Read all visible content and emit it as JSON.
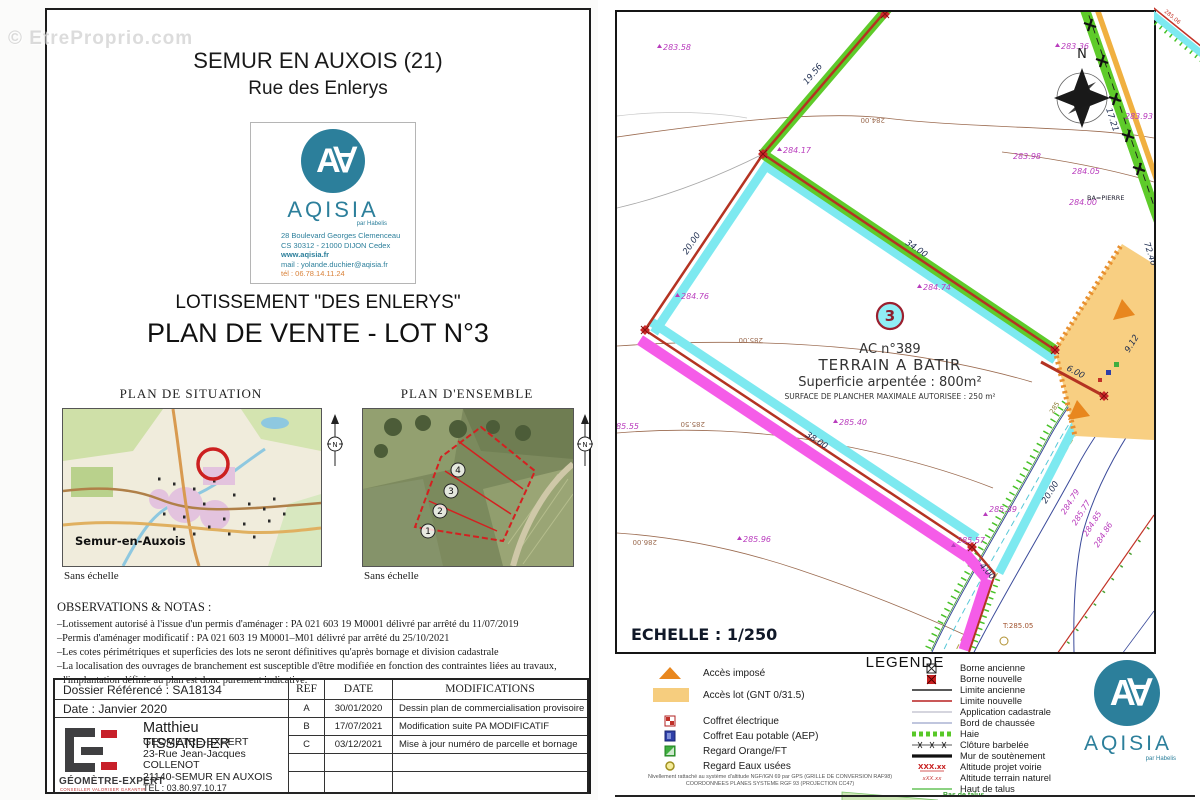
{
  "watermark": "© EtreProprio.com",
  "left_page": {
    "title_line1": "SEMUR EN AUXOIS (21)",
    "title_line2": "Rue des Enlerys",
    "logo": {
      "monogram": "A∀",
      "name": "AQISIA",
      "sub": "par Habelis",
      "address1": "28 Boulevard Georges Clemenceau",
      "address2": "CS 30312 - 21000 DIJON Cedex",
      "web": "www.aqisia.fr",
      "mail": "mail : yolande.duchier@aqisia.fr",
      "tel": "tél : 06.78.14.11.24"
    },
    "subtitle1": "LOTISSEMENT \"DES ENLERYS\"",
    "subtitle2": "PLAN DE VENTE - LOT N°3",
    "map_left_title": "PLAN DE SITUATION",
    "map_right_title": "PLAN D'ENSEMBLE",
    "map_left_caption": "Sans échelle",
    "map_right_caption": "Sans échelle",
    "map_city_label": "Semur-en-Auxois",
    "ensemble_numbers": [
      "1",
      "2",
      "3",
      "4"
    ],
    "observations_title": "OBSERVATIONS & NOTAS :",
    "obs1": "–Lotissement autorisé à l'issue d'un permis d'aménager : PA 021 603 19 M0001 délivré par arrêté du 11/07/2019",
    "obs2": "–Permis d'aménager modificatif : PA 021 603 19 M0001–M01 délivré par arrêté du 25/10/2021",
    "obs3": "–Les cotes périmétriques et superficies des lots ne seront définitives qu'après bornage et division cadastrale",
    "obs4": "–La localisation des ouvrages de branchement est susceptible d'être modifiée en fonction des contraintes liées au travaux,",
    "obs5": "l'implantation définie au plan est donc purement indicative.",
    "table": {
      "dossier": "Dossier Référencé : SA18134",
      "date": "Date : Janvier 2020",
      "headers": [
        "REF",
        "DATE",
        "MODIFICATIONS"
      ],
      "rows": [
        [
          "A",
          "30/01/2020",
          "Dessin plan de commercialisation provisoire"
        ],
        [
          "B",
          "17/07/2021",
          "Modification suite PA MODIFICATIF"
        ],
        [
          "C",
          "03/12/2021",
          "Mise à jour numéro de parcelle et bornage"
        ]
      ],
      "surveyor": {
        "name": "Matthieu TISSANDIER",
        "title": "GEOMETRE-EXPERT",
        "addr1": "23-Rue Jean-Jacques COLLENOT",
        "addr2": "21140-SEMUR EN AUXOIS",
        "tel": "TEL : 03.80.97.10.17",
        "fax": "FAX : 09.70.61.12.20",
        "mail": "matthieu.tissandier@geometre-expert.fr",
        "logo_label": "GÉOMÈTRE-EXPERT",
        "logo_sub": "CONSEILLER VALORISER GARANTIR"
      }
    }
  },
  "plan": {
    "scale": "ECHELLE : 1/250",
    "north": "N",
    "lot": "3",
    "parcel1": "AC n°389",
    "parcel2": "TERRAIN A BATIR",
    "parcel3": "Superficie arpentée : 800m²",
    "parcel4": "SURFACE DE PLANCHER MAXIMALE AUTORISEE : 250 m²",
    "dims": {
      "d1956": "19.56",
      "d2000a": "20.00",
      "d3400": "34.00",
      "d3800": "38.00",
      "d400": "4.00",
      "d600": "6.00",
      "d912": "9.12",
      "d7246": "72.46",
      "d1721": "17.21",
      "d2000b": "20.00"
    },
    "elevs": {
      "e28358": "283.58",
      "e28417": "284.17",
      "e28476": "284.76",
      "e28474": "284.74",
      "e28540": "285.40",
      "e28596": "285.96",
      "e28539": "285.39",
      "e28557": "285.57",
      "e28336": "283.36",
      "e28393": "283.93",
      "e28398": "283.98",
      "e28405": "284.05",
      "e28400": "284.00",
      "e28479": "284.79",
      "e28577": "285.77",
      "e28485": "284.85",
      "e28486": "284.86",
      "e28555": "285.55"
    },
    "contours": {
      "c28400": "284.00",
      "c28500": "285.00",
      "c28550": "285.50",
      "c28600": "286.00"
    },
    "misc": {
      "ba": "BA=PIERRE",
      "t285": "T:285.05",
      "e28506": "285.06",
      "e285": "285"
    }
  },
  "legend": {
    "title": "LEGENDE",
    "left": [
      {
        "label": "Accès imposé"
      },
      {
        "label": "Accès lot (GNT 0/31.5)"
      },
      {
        "label": "Coffret électrique"
      },
      {
        "label": "Coffret Eau potable (AEP)"
      },
      {
        "label": "Regard Orange/FT"
      },
      {
        "label": "Regard Eaux usées"
      }
    ],
    "right": [
      {
        "label": "Borne ancienne"
      },
      {
        "label": "Borne nouvelle"
      },
      {
        "label": "Limite ancienne"
      },
      {
        "label": "Limite nouvelle"
      },
      {
        "label": "Application cadastrale"
      },
      {
        "label": "Bord de chaussée"
      },
      {
        "label": "Haie"
      },
      {
        "label": "Clôture barbelée"
      },
      {
        "label": "Mur de soutènement"
      },
      {
        "label": "Altitude projet voirie"
      },
      {
        "label": "Altitude terrain naturel"
      },
      {
        "label": "Haut de talus"
      }
    ],
    "alt_projet": "XXX.xx",
    "alt_terrain": "xXX.xx",
    "bas_de_talus": "Bas de talus",
    "note1": "Nivellement rattaché au système d'altitude NGF/IGN 69 par GPS (GRILLE DE CONVERSION RAF98)",
    "note2": "COORDONNEES PLANES SYSTEME RGF 93 (PROJECTION CC47)"
  },
  "aqisia_small": {
    "monogram": "A∀",
    "name": "AQISIA",
    "sub": "par Habelis"
  },
  "colors": {
    "teal": "#2c7f9b",
    "haie_green": "#5ecb2a",
    "cyan_band": "#7de9f0",
    "pink_band": "#f55ce8",
    "boundary_red": "#b43322",
    "access_orange": "#f8cf82",
    "triangle_orange": "#e8871e",
    "elev_magenta": "#b93cbd",
    "contour_brown": "#9b6b50"
  }
}
